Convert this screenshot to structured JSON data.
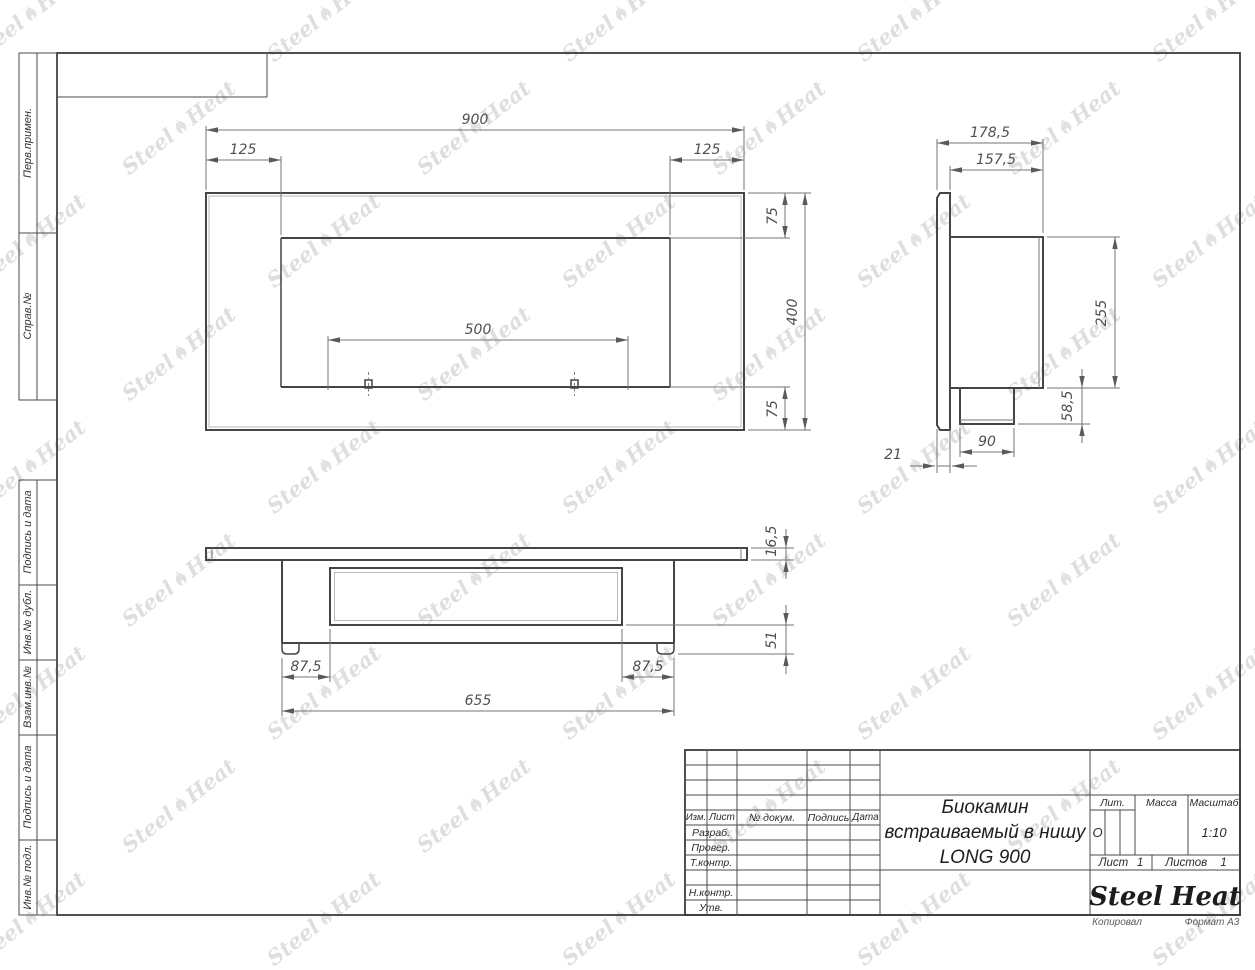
{
  "page": {
    "copied_label": "Копировал",
    "format_label": "Формат А3"
  },
  "watermark": {
    "text_left": "Steel",
    "text_right": "Heat"
  },
  "sidebar": {
    "top_cells": [
      {
        "label": "Перв.примен."
      },
      {
        "label": "Справ.№"
      }
    ],
    "bottom_cells": [
      {
        "label": "Подпись и дата"
      },
      {
        "label": "Инв.№ дубл."
      },
      {
        "label": "Взам.инв.№"
      },
      {
        "label": "Подпись и дата"
      },
      {
        "label": "Инв.№ подл."
      }
    ]
  },
  "title_block": {
    "header_cols": [
      "Изм.",
      "Лист",
      "№ докум.",
      "Подпись",
      "Дата"
    ],
    "row_labels": [
      "Разраб.",
      "Провер.",
      "Т.контр.",
      "",
      "Н.контр.",
      "Утв."
    ],
    "doc_title_line1": "Биокамин",
    "doc_title_line2": "встраиваемый в нишу",
    "doc_title_line3": "LONG 900",
    "lit_label": "Лит.",
    "lit_value": "О",
    "mass_label": "Масса",
    "mass_value": "",
    "scale_label": "Масштаб",
    "scale_value": "1:10",
    "sheet_label": "Лист",
    "sheet_value": "1",
    "sheets_label": "Листов",
    "sheets_value": "1",
    "logo_left": "Steel",
    "logo_right": "Heat",
    "logo_accent_color": "#e8211c"
  },
  "views": {
    "front": {
      "width": "900",
      "left_offset": "125",
      "right_offset": "125",
      "burner_span": "500",
      "top_margin": "75",
      "height": "400",
      "bottom_margin": "75"
    },
    "side": {
      "total_depth": "178,5",
      "body_depth": "157,5",
      "body_height": "255",
      "spigot_height": "58,5",
      "spigot_width": "90",
      "flange_thickness": "21"
    },
    "bottom": {
      "plate_thickness": "16,5",
      "under_depth": "51",
      "left_inset": "87,5",
      "right_inset": "87,5",
      "body_width": "655"
    }
  }
}
